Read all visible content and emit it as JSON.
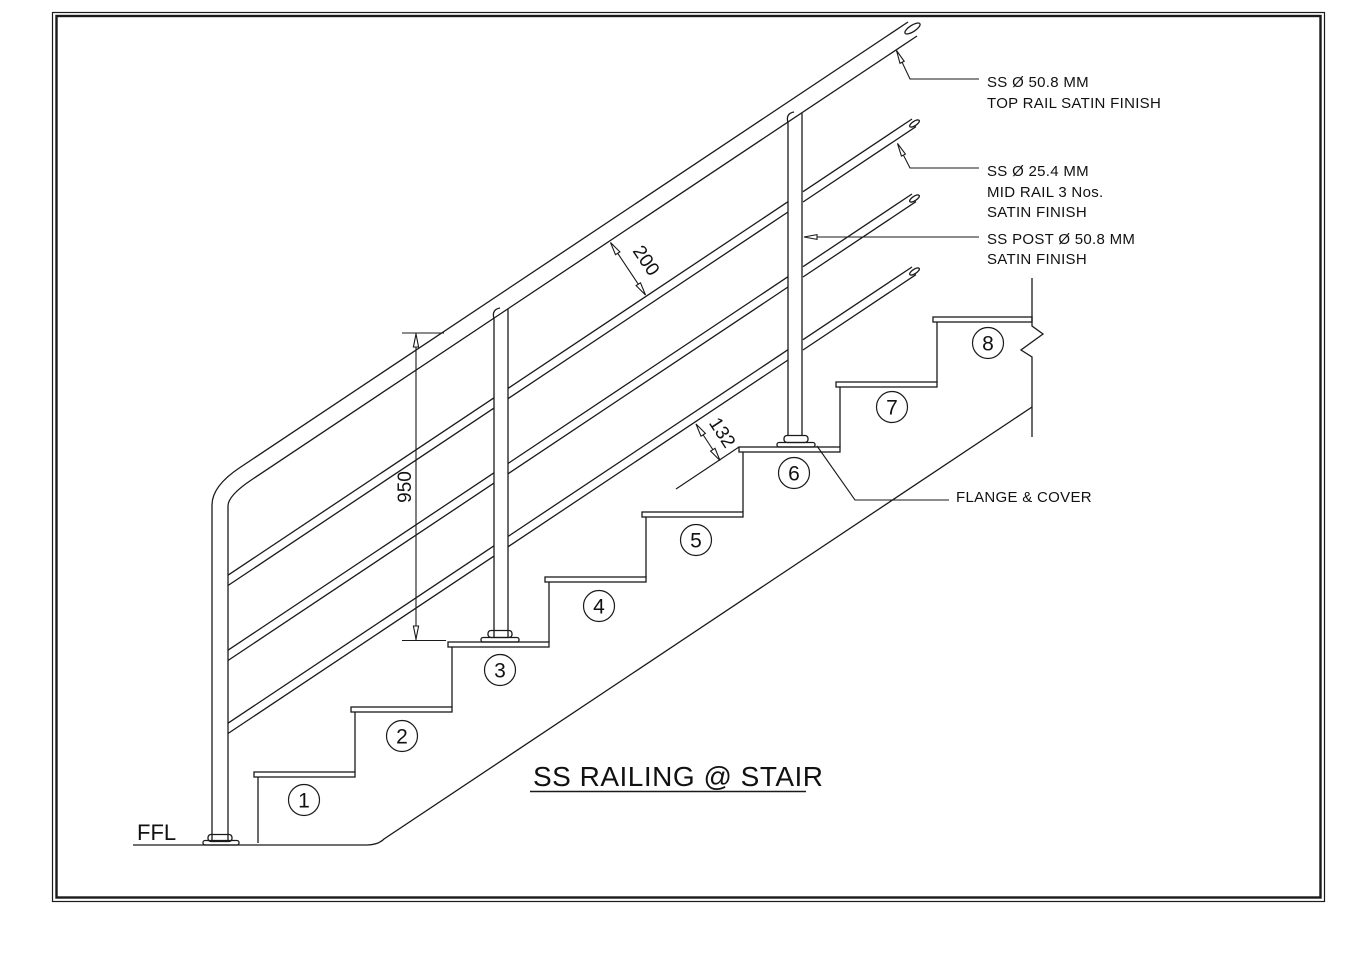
{
  "drawing": {
    "title": "SS RAILING @ STAIR",
    "ffl_label": "FFL",
    "flange_label": "FLANGE & COVER",
    "top_rail_note": [
      "SS Ø 50.8 MM",
      "TOP RAIL SATIN FINISH"
    ],
    "mid_rail_note": [
      "SS Ø 25.4 MM",
      "MID RAIL 3 Nos.",
      "SATIN FINISH"
    ],
    "post_note": [
      "SS POST Ø 50.8 MM",
      "SATIN FINISH"
    ],
    "dimensions": {
      "rail_spacing_mm": "200",
      "railing_height_mm": "950",
      "bottom_gap_mm": "132"
    },
    "step_numbers": [
      "1",
      "2",
      "3",
      "4",
      "5",
      "6",
      "7",
      "8"
    ],
    "colors": {
      "line": "#1a1a1a",
      "background": "#ffffff"
    }
  }
}
